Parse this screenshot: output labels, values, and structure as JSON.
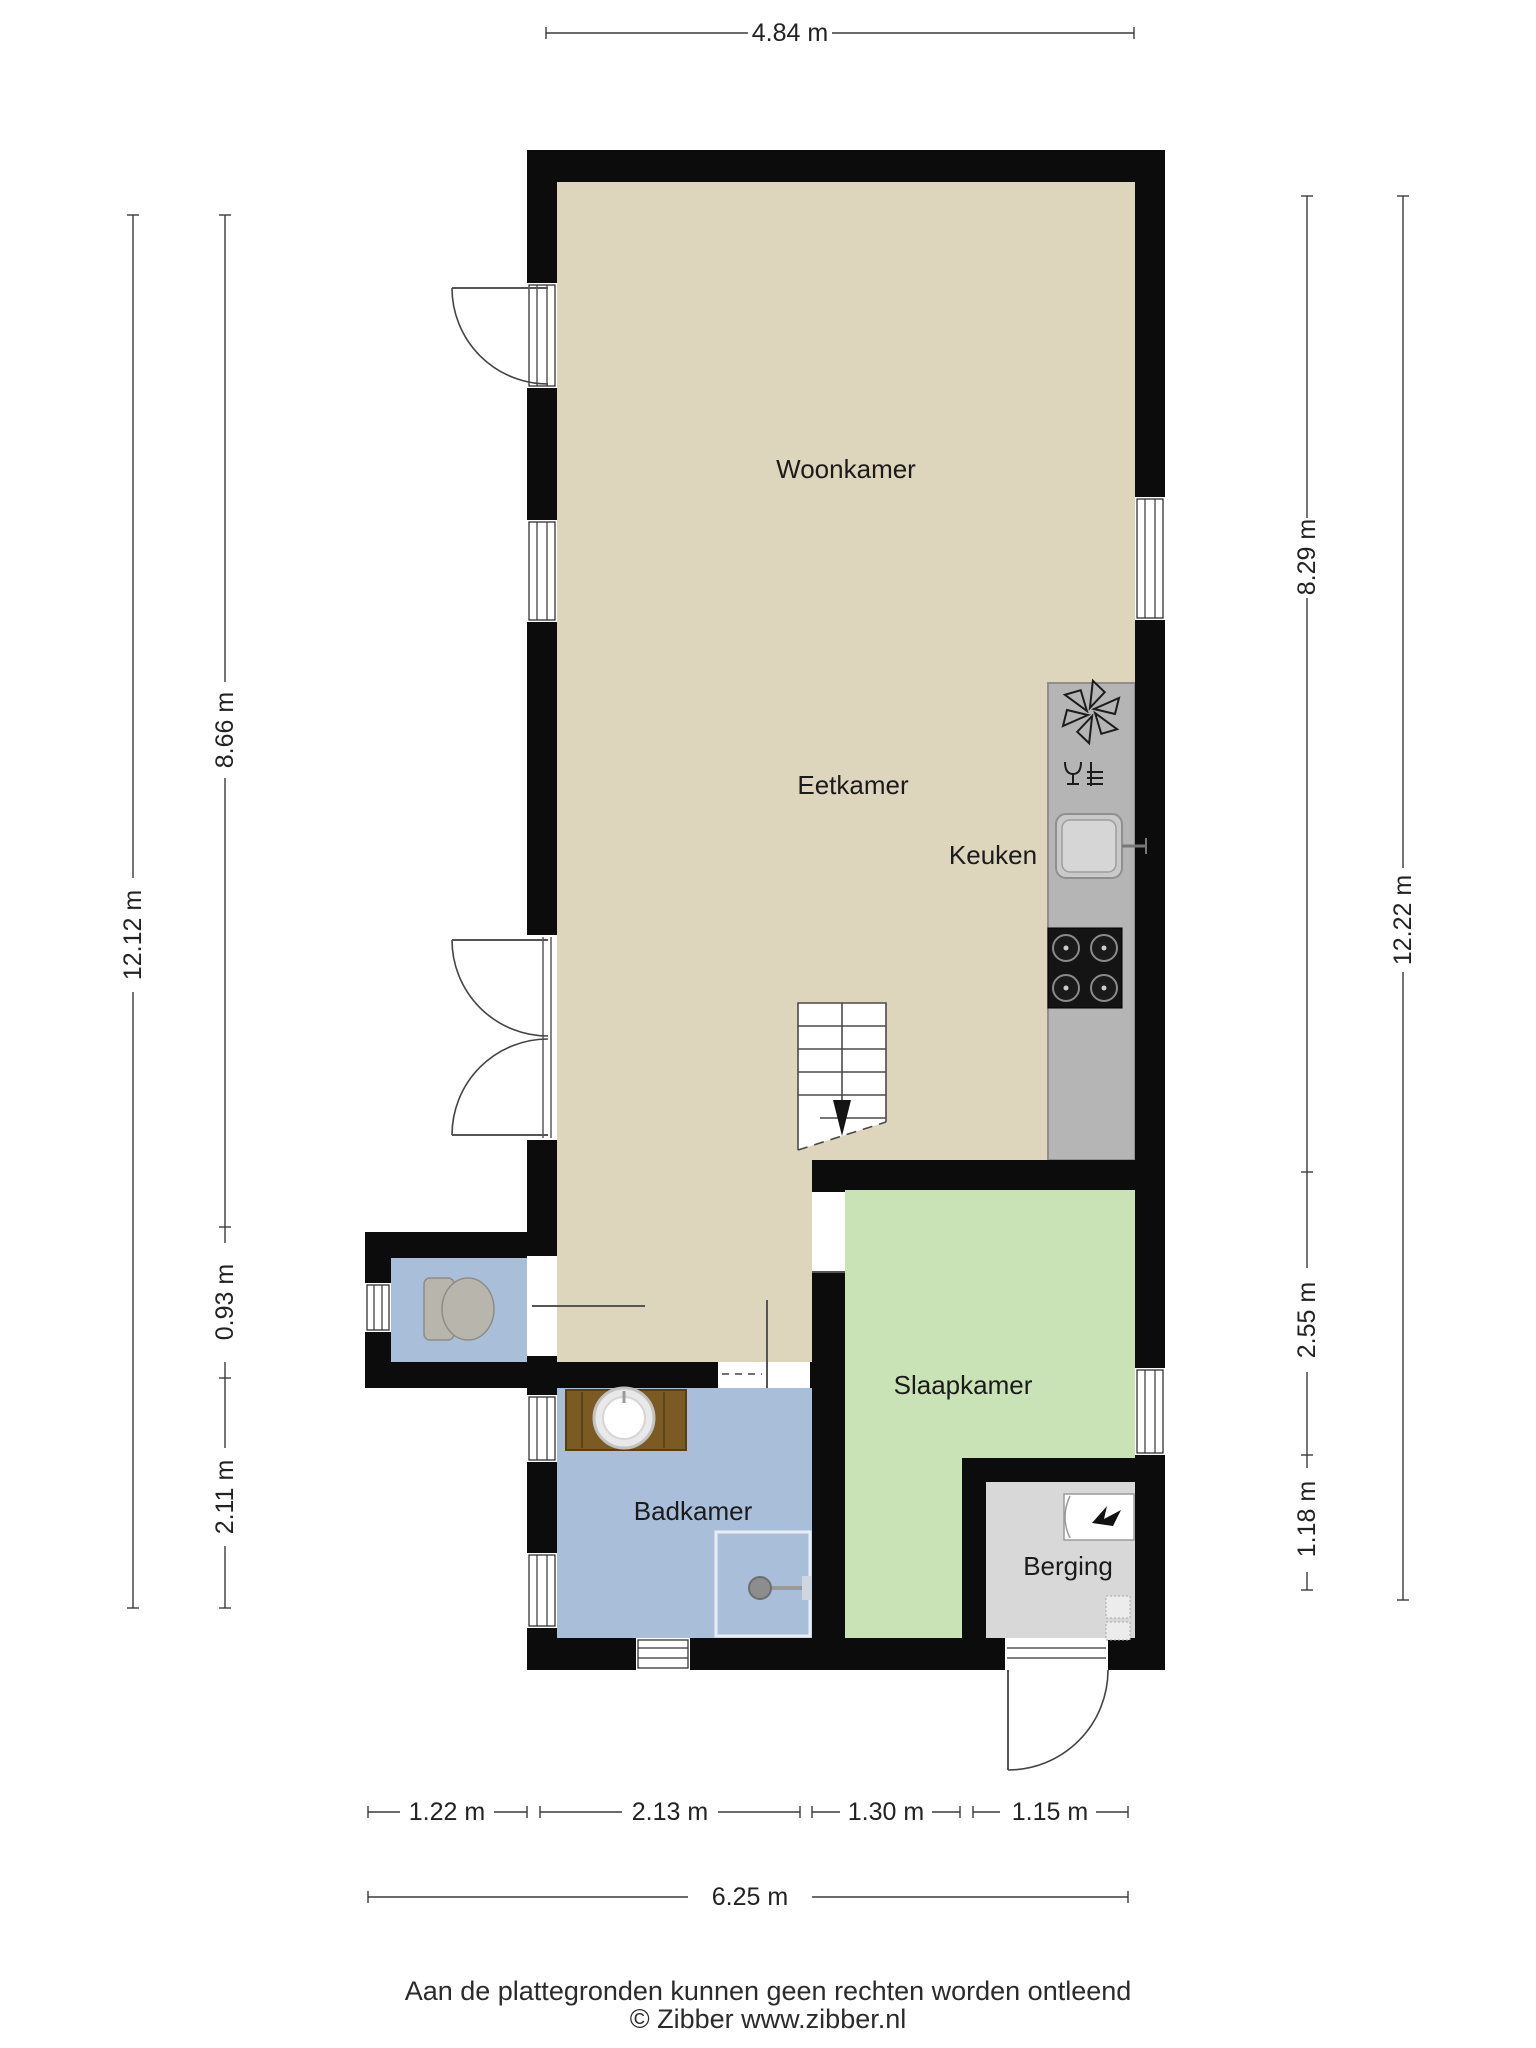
{
  "title": "Floor plan (begane grond)",
  "rooms": {
    "woonkamer": "Woonkamer",
    "eetkamer": "Eetkamer",
    "keuken": "Keuken",
    "slaapkamer": "Slaapkamer",
    "badkamer": "Badkamer",
    "berging": "Berging"
  },
  "dimensions": {
    "top_width": "4.84 m",
    "left": {
      "outer_total": "12.12 m",
      "upper": "8.66 m",
      "middle": "0.93 m",
      "lower": "2.11 m"
    },
    "right": {
      "outer_total": "12.22 m",
      "upper": "8.29 m",
      "middle": "2.55 m",
      "lower": "1.18 m"
    },
    "bottom": {
      "segments": [
        "1.22 m",
        "2.13 m",
        "1.30 m",
        "1.15 m"
      ],
      "total": "6.25 m"
    }
  },
  "footer": {
    "disclaimer": "Aan de plattegronden kunnen geen rechten worden ontleend",
    "copyright": "© Zibber www.zibber.nl"
  },
  "colors": {
    "wall": "#0c0c0c",
    "floor_living": "#ddd6bc",
    "floor_bedroom": "#c9e2b6",
    "floor_bath": "#a9bfd9",
    "floor_storage": "#d8d8d8",
    "kitchen_counter": "#b5b5b5",
    "stove": "#141414",
    "vanity_wood": "#7b5a23"
  },
  "icons": {
    "extractor_fan": "fan-icon",
    "dishwasher": "dishwasher-icon",
    "kitchen_sink": "sink-icon",
    "stove": "stove-icon",
    "toilet": "toilet-icon",
    "vanity_sink": "vanity-sink-icon",
    "shower": "shower-icon",
    "boiler": "boiler-icon",
    "stairs_down": "stairs-down-arrow-icon"
  }
}
